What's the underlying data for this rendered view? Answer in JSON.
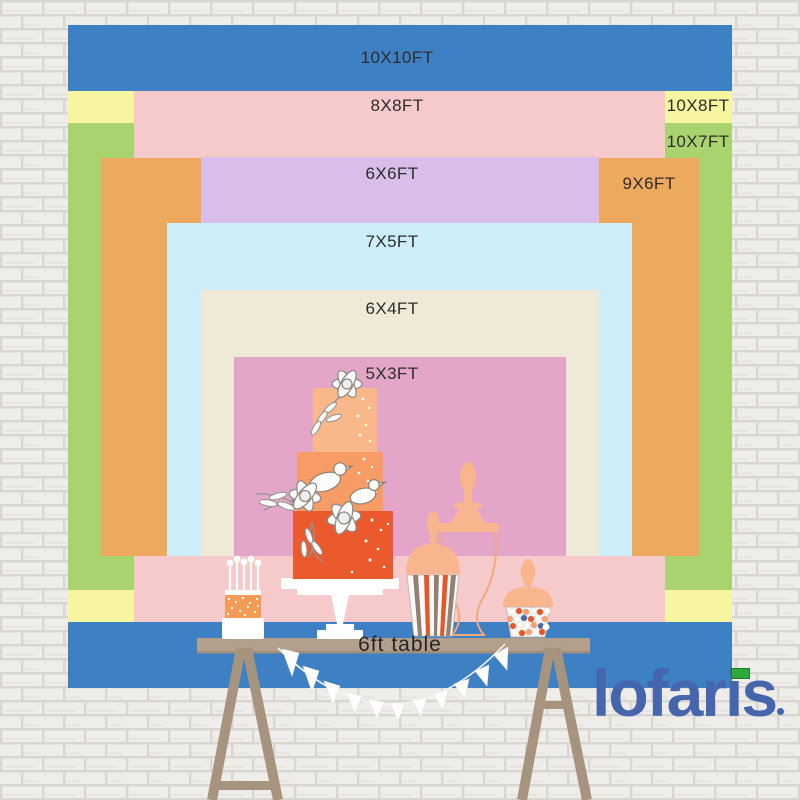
{
  "brand": {
    "logo_text": "lofaris",
    "logo_color": "#4565ad",
    "logo_chip_color": "#2fa83c"
  },
  "table": {
    "label": "6ft table",
    "top_color": "#b2a08c",
    "leg_color": "#a6947f"
  },
  "wall": {
    "brick_color": "#efedea",
    "mortar_color": "#d9d5d1"
  },
  "backdrops": [
    {
      "name": "10x10ft",
      "label": "10X10FT",
      "width_ft": 10,
      "height_ft": 10,
      "color": "#3e80c4",
      "rect": [
        68,
        25,
        664,
        663
      ],
      "label_pos": [
        397,
        58
      ]
    },
    {
      "name": "10x8ft",
      "label": "10X8FT",
      "width_ft": 10,
      "height_ft": 8,
      "color": "#f8f5a1",
      "rect": [
        68,
        91,
        664,
        531
      ],
      "label_pos": [
        698,
        106
      ]
    },
    {
      "name": "10x7ft",
      "label": "10X7FT",
      "width_ft": 10,
      "height_ft": 7,
      "color": "#a9d36f",
      "rect": [
        68,
        123,
        664,
        467
      ],
      "label_pos": [
        698,
        142
      ]
    },
    {
      "name": "8x8ft",
      "label": "8X8FT",
      "width_ft": 8,
      "height_ft": 8,
      "color": "#f6caca",
      "rect": [
        134,
        91,
        531,
        531
      ],
      "label_pos": [
        397,
        106
      ]
    },
    {
      "name": "9x6ft",
      "label": "9X6FT",
      "width_ft": 9,
      "height_ft": 6,
      "color": "#edaa5e",
      "rect": [
        101,
        158,
        598,
        398
      ],
      "label_pos": [
        649,
        184
      ]
    },
    {
      "name": "6x6ft",
      "label": "6X6FT",
      "width_ft": 6,
      "height_ft": 6,
      "color": "#d9bdea",
      "rect": [
        201,
        157,
        398,
        399
      ],
      "label_pos": [
        392,
        174
      ]
    },
    {
      "name": "7x5ft",
      "label": "7X5FT",
      "width_ft": 7,
      "height_ft": 5,
      "color": "#cdeef8",
      "rect": [
        167,
        223,
        465,
        333
      ],
      "label_pos": [
        392,
        242
      ]
    },
    {
      "name": "6x4ft",
      "label": "6X4FT",
      "width_ft": 6,
      "height_ft": 4,
      "color": "#efe9d7",
      "rect": [
        201,
        290,
        398,
        266
      ],
      "label_pos": [
        392,
        309
      ]
    },
    {
      "name": "5x3ft",
      "label": "5X3FT",
      "width_ft": 5,
      "height_ft": 3,
      "color": "#e3a6c9",
      "rect": [
        234,
        357,
        332,
        199
      ],
      "label_pos": [
        392,
        374
      ]
    }
  ]
}
